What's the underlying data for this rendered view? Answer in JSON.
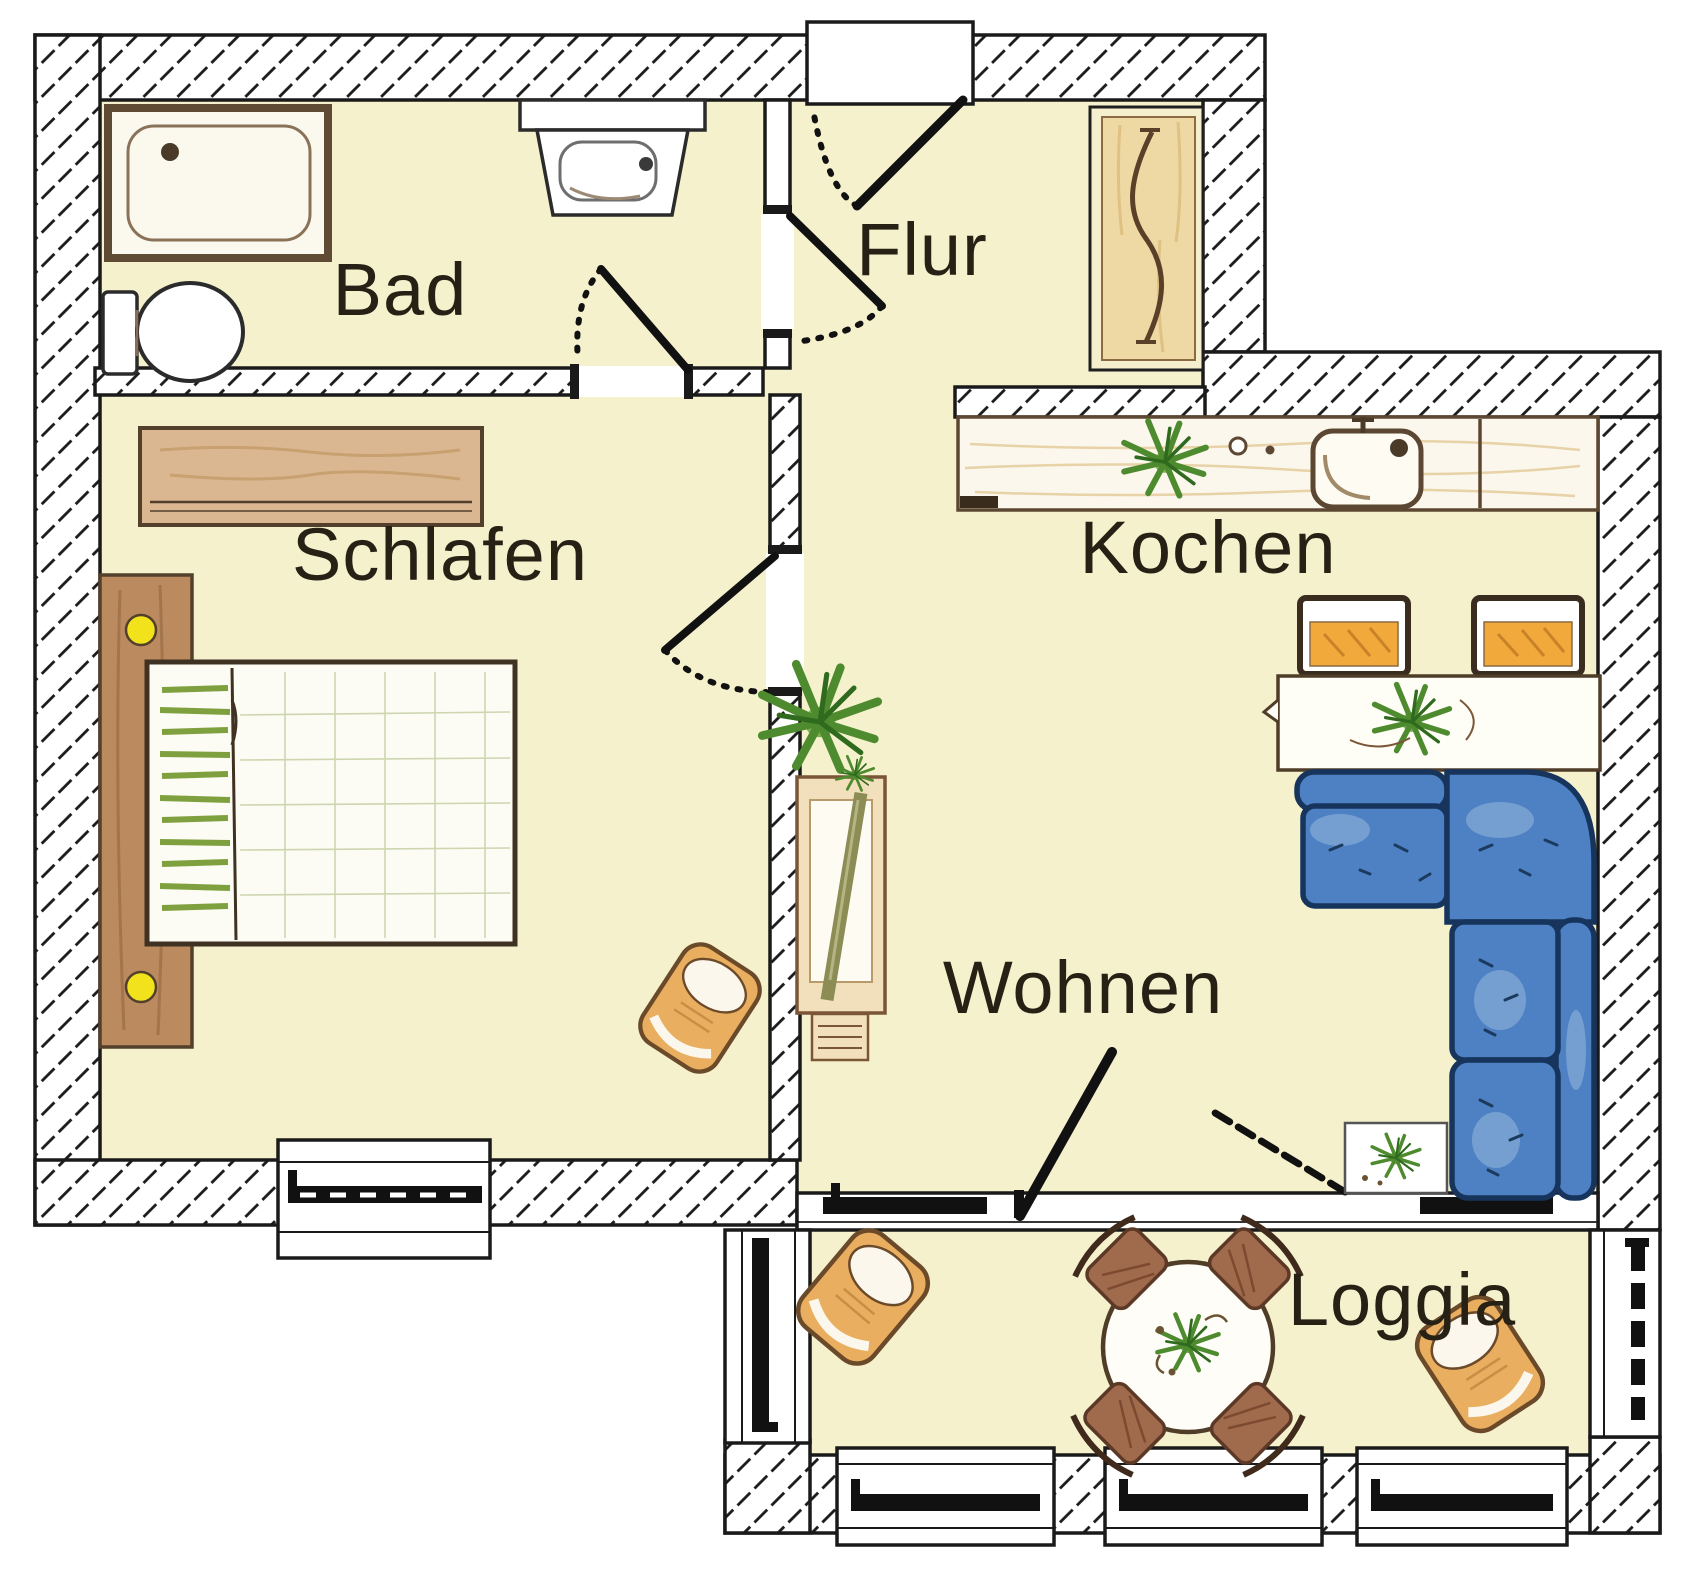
{
  "page": {
    "width_px": 1700,
    "height_px": 1580,
    "type": "apartment floor plan (German labels)"
  },
  "rooms": {
    "bad": {
      "label": "Bad"
    },
    "flur": {
      "label": "Flur"
    },
    "schlafen": {
      "label": "Schlafen"
    },
    "kochen": {
      "label": "Kochen"
    },
    "wohnen": {
      "label": "Wohnen"
    },
    "loggia": {
      "label": "Loggia"
    }
  },
  "colors": {
    "floor": "#f5f1cd",
    "wall_fill": "#ffffff",
    "wall_hatch_line": "#1a1a1a",
    "outline": "#1a1a1a",
    "sofa_blue": "#4e81c4",
    "sofa_outline": "#17355c",
    "wood_light": "#eed9a4",
    "wood_mid": "#dbb791",
    "wood_outline": "#53402c",
    "upholstery_tan": "#e9ae5f",
    "chair_orange": "#f2a93b",
    "chair_brown": "#a06a4c",
    "plant_green": "#4e8a2e",
    "knob_yellow": "#f2e21c",
    "label_text": "#272015"
  }
}
